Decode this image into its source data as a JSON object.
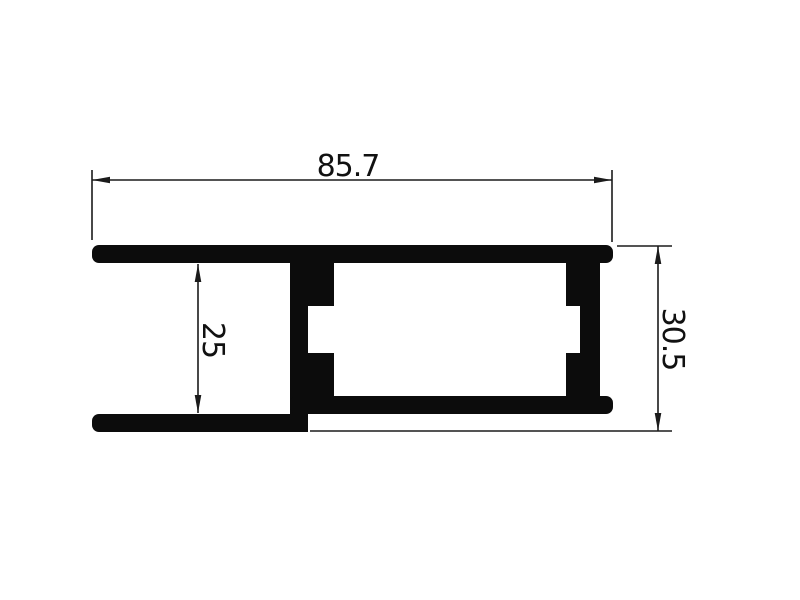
{
  "figure": {
    "background": "#ffffff",
    "ink_color": "#0c0c0c",
    "line_color": "#1b1b1b",
    "dimensions": {
      "overall_width": {
        "value": "85.7",
        "orientation": "horizontal",
        "position": "top"
      },
      "channel_height": {
        "value": "25",
        "orientation": "vertical-rotated",
        "position": "left-interior"
      },
      "overall_height": {
        "value": "30.5",
        "orientation": "vertical-rotated",
        "position": "right"
      }
    }
  }
}
